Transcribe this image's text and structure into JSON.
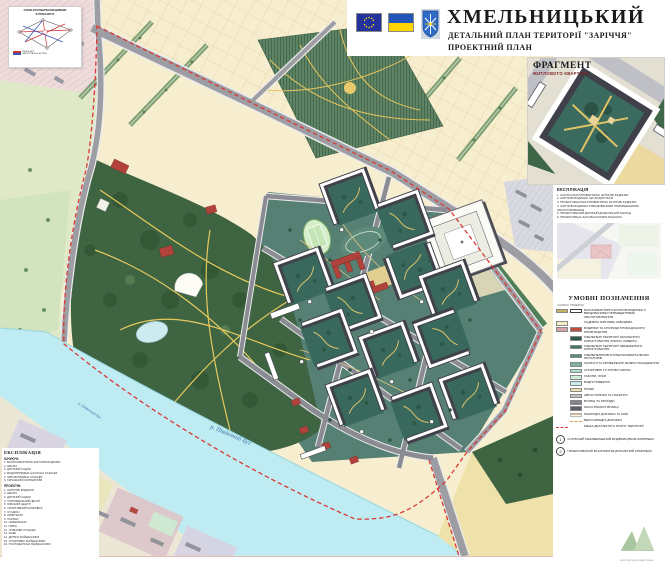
{
  "header": {
    "city": "ХМЕЛЬНИЦЬКИЙ",
    "line1": "ДЕТАЛЬНИЙ ПЛАН ТЕРИТОРІЇ \"ЗАРІЧЧЯ\"",
    "line2": "ПРОЕКТНИЙ ПЛАН"
  },
  "fragment": {
    "title": "ФРАГМЕНТ",
    "subtitle": "ЖИТЛОВОГО КВАРТАЛУ"
  },
  "scheme": {
    "title1": "СХЕМА РОЗТАШУВАННЯ ДІЛЯНКИ",
    "title2": "В ПЛАНІ МІСТА",
    "legend": [
      {
        "color": "#cc3434",
        "text": "МЕЖА ДПТ"
      },
      {
        "color": "#3355bb",
        "text": "МАГІСТРАЛЬНІ ВУЛИЦІ"
      }
    ]
  },
  "building_list": {
    "title": "ЕКСПЛІКАЦІЯ",
    "items": [
      "1. ІСНУЮЧІ БАГАТОКВАРТИРНІ ЖИТЛОВІ БУДИНКИ",
      "2. ЖИТЛОВІ БУДИНКИ, ЩО БУДУЮТЬСЯ",
      "3. ПРОЕКТОВАНІ БАГАТОКВАРТИРНІ ЖИТЛОВІ БУДИНКИ",
      "4. ЖИТЛОВІ БУДИНКИ З ВБУДОВАНИМИ ПРИМІЩЕННЯМИ ОБСЛУГОВУВАННЯ",
      "5. ПРОЕКТОВАНИЙ ДИТЯЧИЙ ДОШКІЛЬНИЙ ЗАКЛАД",
      "6. ПРОЕКТОВАНА ЗАГАЛЬНООСВІТНЯ ШКОЛА"
    ]
  },
  "legend": {
    "title": "УМОВНІ ПОЗНАЧЕННЯ",
    "col_existing": "ІСНУЮЧІ",
    "col_projected": "ПРОЕКТНІ",
    "rows": [
      {
        "ex": "#c6b264",
        "pr": "outline",
        "label": "БАГАТОКВАРТИРНІ ЖИТЛОВІ БУДИНКИ З ВБУДОВАНИМИ ПРИМІЩЕННЯМИ ОБСЛУГОВУВАННЯ"
      },
      {
        "ex": "#f3eec6",
        "label": "САДИБНА ЖИТЛОВА ЗАБУДОВА"
      },
      {
        "ex": "#d8a3a7",
        "pr": "#c04b45",
        "label": "БУДИНКИ ТА СПОРУДИ ГРОМАДСЬКОГО ПРИЗНАЧЕННЯ"
      },
      {
        "pr": "#2e5a4c",
        "label": "ОЗЕЛЕНЕНІ ТЕРИТОРІЇ ЗАГАЛЬНОГО КОРИСТУВАННЯ (ПАРКИ, СКВЕРИ)"
      },
      {
        "pr": "#417464",
        "label": "ОЗЕЛЕНЕНІ ТЕРИТОРІЇ ОБМЕЖЕНОГО КОРИСТУВАННЯ"
      },
      {
        "pr": "#598c7c",
        "label": "ОЗЕЛЕНЕННЯ ВНУТРІШНЬОКВАРТАЛЬНИХ ПРОСТОРІВ"
      },
      {
        "pr": "#7fb3a0",
        "label": "ЗАХИСНІ ТА ПРИБЕРЕЖНІ ЗЕЛЕНІ НАСАДЖЕННЯ"
      },
      {
        "pr": "#a8dbc8",
        "label": "СПОРТИВНІ ТА ІГРОВІ ГАЗОНИ"
      },
      {
        "pr": "#cdeede",
        "label": "ГАЗОНИ, ЛУКИ"
      },
      {
        "pr": "#c9eef2",
        "label": "ВОДНІ ПОВЕРХНІ"
      },
      {
        "pr": "#f0e2ab",
        "label": "ПЛЯЖІ"
      },
      {
        "pr": "#c2c2cb",
        "label": "АВТОСТОЯНКИ ТА ПАРКІНГИ"
      },
      {
        "pr": "#84848d",
        "label": "ВУЛИЦІ ТА ПРОЇЗДИ"
      },
      {
        "pr": "#5f5f68",
        "label": "МАГІСТРАЛЬНІ ВУЛИЦІ"
      },
      {
        "pr": "lines-tan",
        "label": "ПІШОХІДНІ ДОРІЖКИ ТА АЛЕЇ"
      },
      {
        "pr": "dash-orange",
        "label": "ВЕЛОСИПЕДНІ ДОРІЖКИ"
      },
      {
        "ex": "dash-red",
        "label": "МЕЖА ДЕТАЛЬНОГО ПЛАНУ ТЕРИТОРІЇ"
      }
    ],
    "notes": [
      {
        "num": "1",
        "text": "ІСНУЮЧИЙ НЕЗАВЕРШЕНИЙ БУДІВНИЦТВОМ КОМПЛЕКС"
      },
      {
        "num": "2",
        "text": "ПРОЕКТОВАНИЙ БАГАТОФУНКЦІОНАЛЬНИЙ КОМПЛЕКС"
      }
    ]
  },
  "explication": {
    "title": "ЕКСПЛІКАЦІЯ",
    "group_existing": "ІСНУЮЧІ:",
    "existing": [
      "1. БАГАТОКВАРТИРНІ ЖИТЛОВІ БУДИНКИ",
      "2. ШКОЛА",
      "3. ДИТЯЧИЙ САДОК",
      "4. ВОДОПРОВІДНА НАСОСНА СТАНЦІЯ",
      "5. АВТОЗАПРАВНА СТАНЦІЯ",
      "6. ГАРАЖНИЙ КООПЕРАТИВ"
    ],
    "group_projected": "ПРОЕКТНІ:",
    "projected": [
      "1. ЖИТЛОВІ БУДИНКИ",
      "2. ШКОЛА",
      "3. ДИТЯЧИЙ САДОК",
      "4. ТОРГОВЕЛЬНИЙ ЦЕНТР",
      "5. ОФІСНИЙ ЦЕНТР",
      "6. СПОРТИВНИЙ КОМПЛЕКС",
      "7. СТАДІОН",
      "8. АМФІТЕАТР",
      "9. ПАРКІНГ",
      "10. НАБЕРЕЖНА",
      "11. ПЛЯЖ",
      "12. ЧОВНОВА СТАНЦІЯ",
      "13. КАФЕ",
      "14. ДИТЯЧІ МАЙДАНЧИКИ",
      "15. СПОРТИВНІ МАЙДАНЧИКИ",
      "16. ГОСПОДАРСЬКІ МАЙДАНЧИКИ"
    ]
  },
  "map": {
    "river_label": "р. Південний Буг"
  },
  "logo": {
    "caption": "архітектурна майстерня"
  },
  "colors": {
    "boundary": "#d93a34",
    "water": "#bfecf2",
    "park": "#3e6442",
    "sand": "#f1e3ad",
    "courtyard": "#39695c",
    "road": "#8b8b93",
    "cream": "#f7eecf"
  }
}
